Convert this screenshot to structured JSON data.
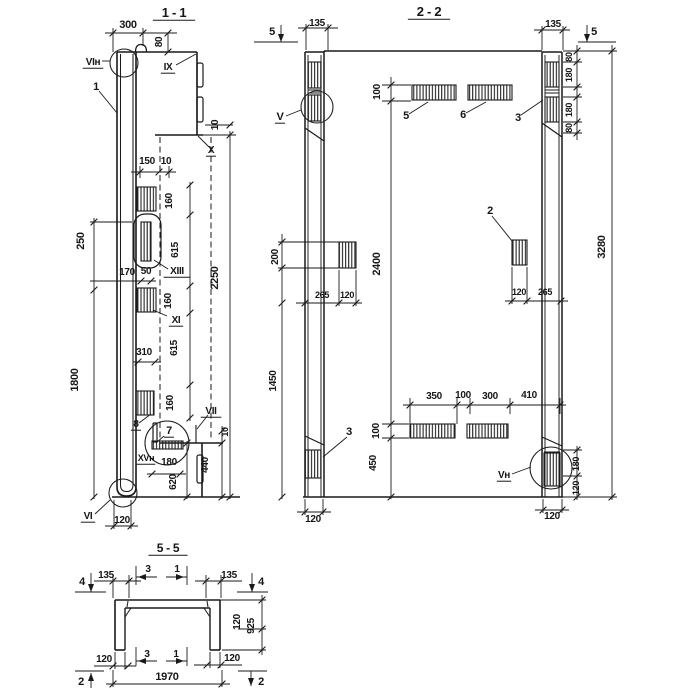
{
  "document": {
    "kind": "structural panel shop drawing, sections",
    "colors": {
      "ink": "#1a1a1a",
      "paper": "#ffffff"
    }
  },
  "s11": {
    "title": "1 - 1",
    "d300": "300",
    "d80": "80",
    "rVIn": "VIн",
    "p1": "1",
    "rIX": "IX",
    "d10a": "10",
    "rX": "X",
    "d150": "150",
    "d10b": "10",
    "d160a": "160",
    "d615a": "615",
    "d160b": "160",
    "d615b": "615",
    "d160c": "160",
    "d2250": "2250",
    "d250": "250",
    "d1800": "1800",
    "d170": "170",
    "d50": "50",
    "rXIII": "XIII",
    "rXI": "XI",
    "d310": "310",
    "p8": "8",
    "p7": "7",
    "rXVn": "XVн",
    "d180": "180",
    "d620": "620",
    "d440": "440",
    "d10c": "10",
    "rVII": "VII",
    "rVI": "VI",
    "d120": "120"
  },
  "s22": {
    "title": "2 - 2",
    "m5l": "5",
    "m5r": "5",
    "d135l": "135",
    "d135r": "135",
    "c80a": "80",
    "c180a": "180",
    "c180b": "180",
    "c80b": "80",
    "d100t": "100",
    "p5": "5",
    "p6": "6",
    "p3t": "3",
    "rV": "V",
    "d200": "200",
    "d2400": "2400",
    "p2": "2",
    "d3280": "3280",
    "d265l": "265",
    "d120l": "120",
    "d120r": "120",
    "d265r": "265",
    "d1450": "1450",
    "d350": "350",
    "d100m": "100",
    "d300": "300",
    "d410": "410",
    "d100b": "100",
    "d450": "450",
    "p3b": "3",
    "rVn": "Vн",
    "c180c": "180",
    "c120c": "120",
    "d120bl": "120",
    "d120br": "120"
  },
  "s55": {
    "title": "5 - 5",
    "m4l": "4",
    "m4r": "4",
    "d135l": "135",
    "d135r": "135",
    "m3t": "3",
    "m1t": "1",
    "d120r": "120",
    "d925": "925",
    "d120bl": "120",
    "m3b": "3",
    "m1b": "1",
    "d120br": "120",
    "d1970": "1970",
    "m2l": "2",
    "m2r": "2"
  }
}
